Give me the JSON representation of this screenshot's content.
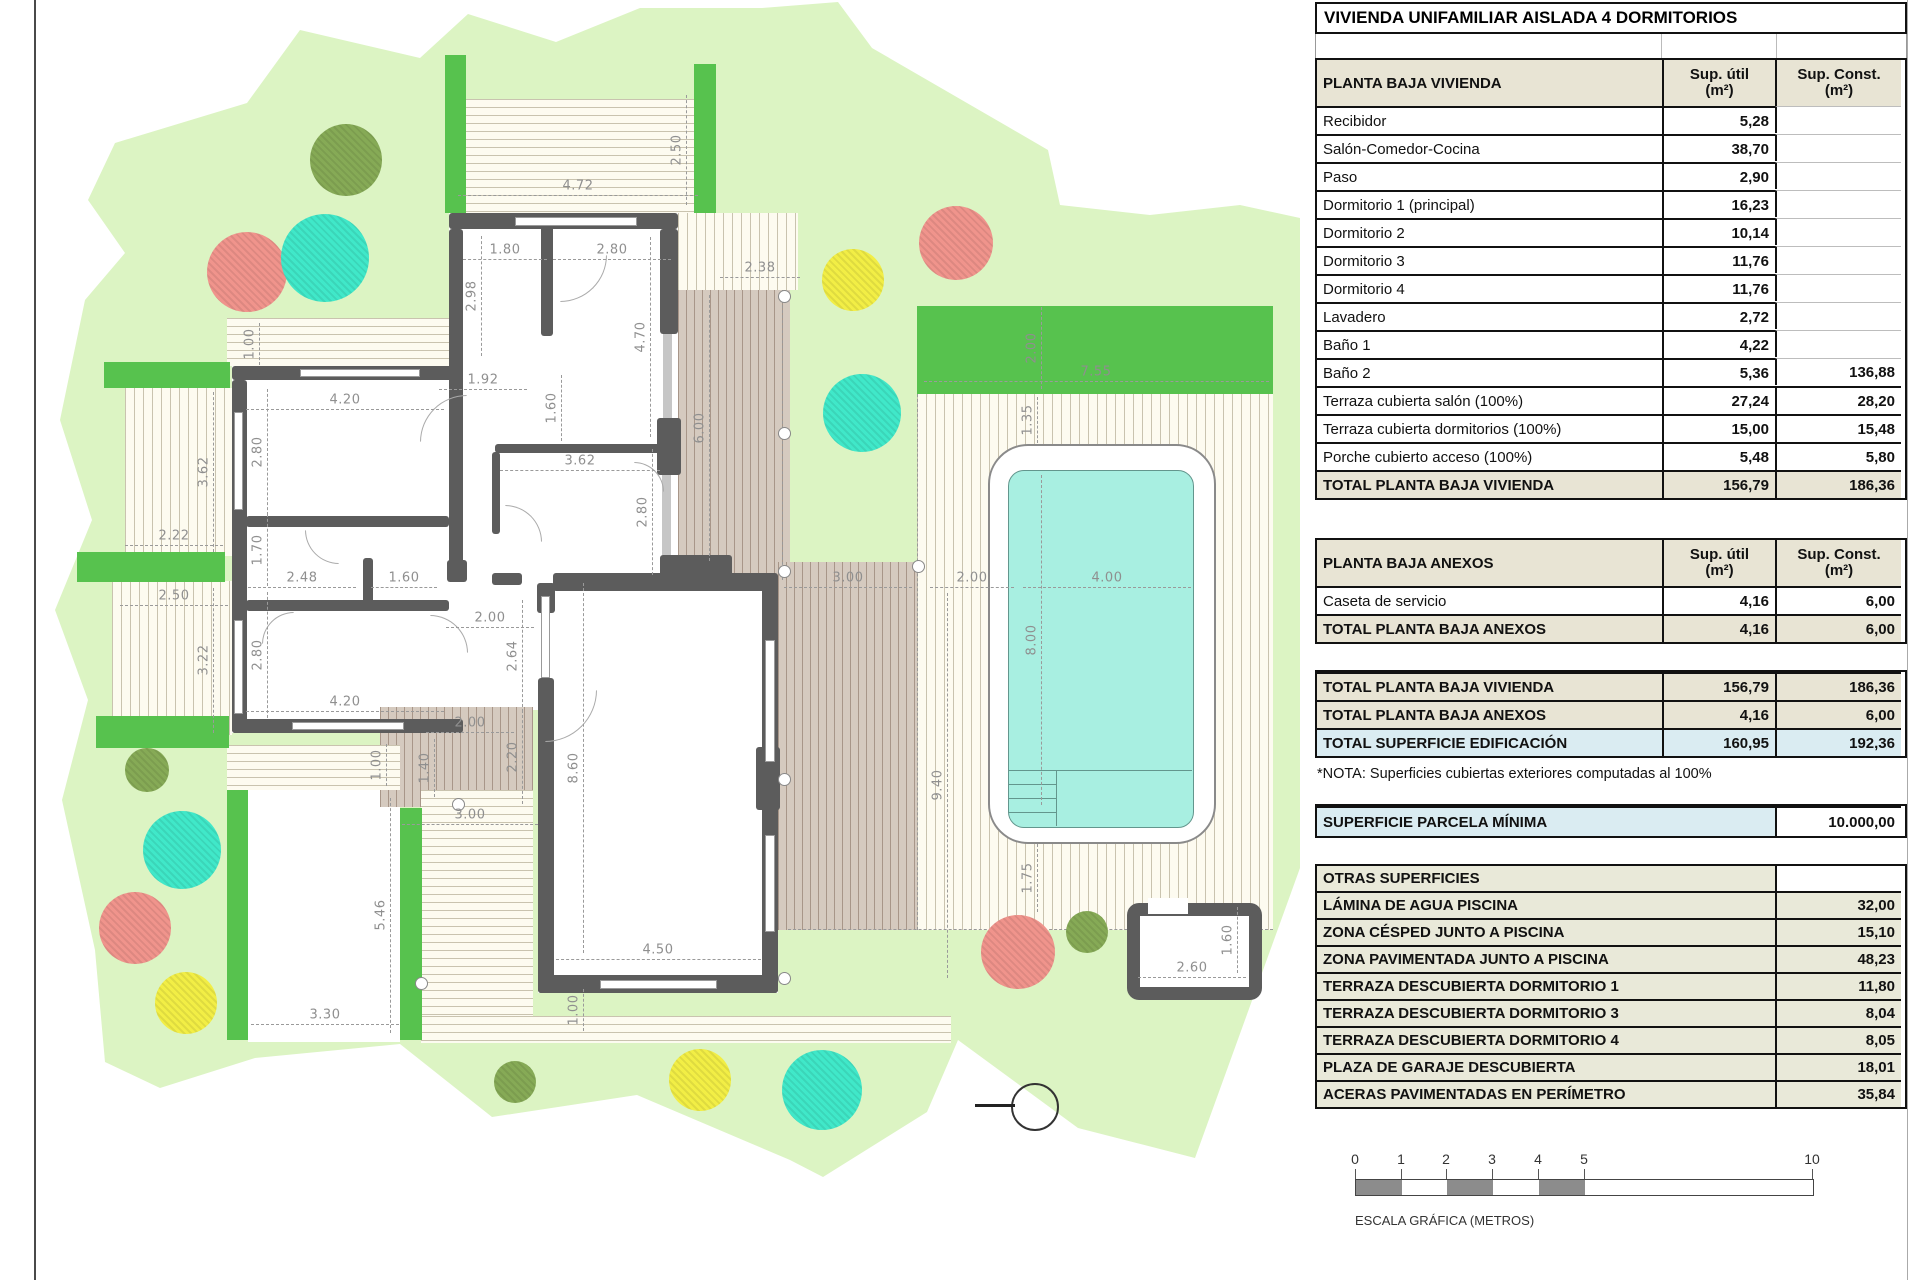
{
  "title": "VIVIENDA UNIFAMILIAR AISLADA 4 DORMITORIOS",
  "tables": {
    "col_util": "Sup. útil",
    "col_const": "Sup. Const.",
    "col_unit": "(m²)",
    "vivienda": {
      "title": "PLANTA BAJA VIVIENDA",
      "rows": [
        {
          "label": "Recibidor",
          "util": "5,28",
          "const": ""
        },
        {
          "label": "Salón-Comedor-Cocina",
          "util": "38,70",
          "const": ""
        },
        {
          "label": "Paso",
          "util": "2,90",
          "const": ""
        },
        {
          "label": "Dormitorio 1 (principal)",
          "util": "16,23",
          "const": ""
        },
        {
          "label": "Dormitorio 2",
          "util": "10,14",
          "const": ""
        },
        {
          "label": "Dormitorio 3",
          "util": "11,76",
          "const": ""
        },
        {
          "label": "Dormitorio 4",
          "util": "11,76",
          "const": ""
        },
        {
          "label": "Lavadero",
          "util": "2,72",
          "const": ""
        },
        {
          "label": "Baño 1",
          "util": "4,22",
          "const": ""
        },
        {
          "label": "Baño 2",
          "util": "5,36",
          "const": "136,88"
        },
        {
          "label": "Terraza cubierta salón (100%)",
          "util": "27,24",
          "const": "28,20"
        },
        {
          "label": "Terraza cubierta dormitorios (100%)",
          "util": "15,00",
          "const": "15,48"
        },
        {
          "label": "Porche cubierto acceso (100%)",
          "util": "5,48",
          "const": "5,80"
        }
      ],
      "total": {
        "label": "TOTAL PLANTA BAJA VIVIENDA",
        "util": "156,79",
        "const": "186,36"
      }
    },
    "anexos": {
      "title": "PLANTA BAJA ANEXOS",
      "rows": [
        {
          "label": "Caseta de servicio",
          "util": "4,16",
          "const": "6,00"
        }
      ],
      "total": {
        "label": "TOTAL PLANTA BAJA ANEXOS",
        "util": "4,16",
        "const": "6,00"
      }
    },
    "resumen": {
      "rows": [
        {
          "label": "TOTAL PLANTA BAJA VIVIENDA",
          "util": "156,79",
          "const": "186,36",
          "style": "beige"
        },
        {
          "label": "TOTAL PLANTA BAJA ANEXOS",
          "util": "4,16",
          "const": "6,00",
          "style": "beige"
        },
        {
          "label": "TOTAL SUPERFICIE EDIFICACIÓN",
          "util": "160,95",
          "const": "192,36",
          "style": "blue"
        }
      ]
    },
    "nota": "*NOTA: Superficies cubiertas exteriores computadas al 100%",
    "parcela": {
      "label": "SUPERFICIE PARCELA MÍNIMA",
      "value": "10.000,00"
    },
    "otras": {
      "title": "OTRAS SUPERFICIES",
      "rows": [
        {
          "label": "LÁMINA DE AGUA PISCINA",
          "value": "32,00"
        },
        {
          "label": "ZONA CÉSPED JUNTO A PISCINA",
          "value": "15,10"
        },
        {
          "label": "ZONA PAVIMENTADA JUNTO A PISCINA",
          "value": "48,23"
        },
        {
          "label": "TERRAZA DESCUBIERTA DORMITORIO 1",
          "value": "11,80"
        },
        {
          "label": "TERRAZA DESCUBIERTA DORMITORIO 3",
          "value": "8,04"
        },
        {
          "label": "TERRAZA DESCUBIERTA DORMITORIO 4",
          "value": "8,05"
        },
        {
          "label": "PLAZA DE GARAJE DESCUBIERTA",
          "value": "18,01"
        },
        {
          "label": "ACERAS PAVIMENTADAS EN PERÍMETRO",
          "value": "35,84"
        }
      ]
    }
  },
  "scalebar": {
    "caption": "ESCALA GRÁFICA (METROS)",
    "ticks": [
      {
        "t": "0",
        "p": 0
      },
      {
        "t": "1",
        "p": 46
      },
      {
        "t": "2",
        "p": 91
      },
      {
        "t": "3",
        "p": 137
      },
      {
        "t": "4",
        "p": 183
      },
      {
        "t": "5",
        "p": 229
      },
      {
        "t": "10",
        "p": 457
      }
    ],
    "segments": [
      {
        "w": 46,
        "c": "#8c8c8c"
      },
      {
        "w": 45,
        "c": "#ffffff"
      },
      {
        "w": 46,
        "c": "#8c8c8c"
      },
      {
        "w": 46,
        "c": "#ffffff"
      },
      {
        "w": 46,
        "c": "#8c8c8c"
      },
      {
        "w": 228,
        "c": "#ffffff"
      }
    ]
  },
  "plan": {
    "colors": {
      "garden": "#dcf4c3",
      "hedge": "#57c24e",
      "wall": "#5c5c5c",
      "pool_water": "#a8efe1",
      "tree_red": "#f0948c",
      "tree_teal": "#40e8c9",
      "tree_yellow": "#f2ee45",
      "tree_olive": "#86aa56"
    },
    "dims": [
      {
        "t": "2.50",
        "x": 677,
        "y": 150,
        "r": 1,
        "len": 110
      },
      {
        "t": "4.72",
        "x": 578,
        "y": 186,
        "r": 0,
        "len": 240
      },
      {
        "t": "1.80",
        "x": 505,
        "y": 250,
        "r": 0,
        "len": 84
      },
      {
        "t": "2.80",
        "x": 612,
        "y": 250,
        "r": 0,
        "len": 118
      },
      {
        "t": "2.38",
        "x": 760,
        "y": 268,
        "r": 0,
        "len": 80
      },
      {
        "t": "2.98",
        "x": 472,
        "y": 296,
        "r": 1,
        "len": 120
      },
      {
        "t": "1.00",
        "x": 250,
        "y": 344,
        "r": 1,
        "len": 42
      },
      {
        "t": "4.70",
        "x": 641,
        "y": 337,
        "r": 1,
        "len": 200
      },
      {
        "t": "1.92",
        "x": 483,
        "y": 380,
        "r": 0,
        "len": 88
      },
      {
        "t": "4.20",
        "x": 345,
        "y": 400,
        "r": 0,
        "len": 198
      },
      {
        "t": "2.80",
        "x": 258,
        "y": 452,
        "r": 1,
        "len": 126
      },
      {
        "t": "3.62",
        "x": 204,
        "y": 472,
        "r": 1,
        "len": 160
      },
      {
        "t": "1.60",
        "x": 552,
        "y": 408,
        "r": 1,
        "len": 66
      },
      {
        "t": "3.62",
        "x": 580,
        "y": 461,
        "r": 0,
        "len": 160
      },
      {
        "t": "6.00",
        "x": 700,
        "y": 428,
        "r": 1,
        "len": 266
      },
      {
        "t": "2.22",
        "x": 174,
        "y": 536,
        "r": 0,
        "len": 98
      },
      {
        "t": "1.70",
        "x": 258,
        "y": 550,
        "r": 1,
        "len": 72
      },
      {
        "t": "2.48",
        "x": 302,
        "y": 578,
        "r": 0,
        "len": 108
      },
      {
        "t": "1.60",
        "x": 404,
        "y": 578,
        "r": 0,
        "len": 66
      },
      {
        "t": "2.80",
        "x": 643,
        "y": 512,
        "r": 1,
        "len": 126
      },
      {
        "t": "2.50",
        "x": 174,
        "y": 596,
        "r": 0,
        "len": 108
      },
      {
        "t": "3.22",
        "x": 204,
        "y": 660,
        "r": 1,
        "len": 145
      },
      {
        "t": "2.80",
        "x": 258,
        "y": 655,
        "r": 1,
        "len": 126
      },
      {
        "t": "4.20",
        "x": 345,
        "y": 702,
        "r": 0,
        "len": 198
      },
      {
        "t": "2.00",
        "x": 490,
        "y": 618,
        "r": 0,
        "len": 88
      },
      {
        "t": "2.64",
        "x": 513,
        "y": 656,
        "r": 1,
        "len": 112
      },
      {
        "t": "2.00",
        "x": 470,
        "y": 723,
        "r": 0,
        "len": 88
      },
      {
        "t": "2.20",
        "x": 513,
        "y": 757,
        "r": 1,
        "len": 94
      },
      {
        "t": "1.40",
        "x": 425,
        "y": 768,
        "r": 1,
        "len": 58
      },
      {
        "t": "1.00",
        "x": 377,
        "y": 765,
        "r": 1,
        "len": 42
      },
      {
        "t": "3.00",
        "x": 470,
        "y": 815,
        "r": 0,
        "len": 136
      },
      {
        "t": "8.60",
        "x": 574,
        "y": 768,
        "r": 1,
        "len": 370
      },
      {
        "t": "5.46",
        "x": 381,
        "y": 915,
        "r": 1,
        "len": 235
      },
      {
        "t": "3.30",
        "x": 325,
        "y": 1015,
        "r": 0,
        "len": 148
      },
      {
        "t": "4.50",
        "x": 658,
        "y": 950,
        "r": 0,
        "len": 205
      },
      {
        "t": "1.00",
        "x": 574,
        "y": 1010,
        "r": 1,
        "len": 42
      },
      {
        "t": "3.00",
        "x": 848,
        "y": 578,
        "r": 0,
        "len": 128
      },
      {
        "t": "2.00",
        "x": 972,
        "y": 578,
        "r": 0,
        "len": 84
      },
      {
        "t": "4.00",
        "x": 1107,
        "y": 578,
        "r": 0,
        "len": 168
      },
      {
        "t": "8.00",
        "x": 1032,
        "y": 640,
        "r": 1,
        "len": 330
      },
      {
        "t": "9.40",
        "x": 938,
        "y": 785,
        "r": 1,
        "len": 385
      },
      {
        "t": "2.00",
        "x": 1032,
        "y": 348,
        "r": 1,
        "len": 82
      },
      {
        "t": "7.55",
        "x": 1096,
        "y": 372,
        "r": 0,
        "len": 345
      },
      {
        "t": "1.35",
        "x": 1028,
        "y": 420,
        "r": 1,
        "len": 46
      },
      {
        "t": "1.75",
        "x": 1028,
        "y": 878,
        "r": 1,
        "len": 68
      },
      {
        "t": "2.60",
        "x": 1192,
        "y": 968,
        "r": 0,
        "len": 108
      },
      {
        "t": "1.60",
        "x": 1228,
        "y": 940,
        "r": 1,
        "len": 66
      }
    ],
    "trees": [
      {
        "x": 346,
        "y": 160,
        "rad": 36,
        "c": "tree_olive"
      },
      {
        "x": 247,
        "y": 272,
        "rad": 40,
        "c": "tree_red"
      },
      {
        "x": 325,
        "y": 258,
        "rad": 44,
        "c": "tree_teal"
      },
      {
        "x": 853,
        "y": 280,
        "rad": 31,
        "c": "tree_yellow"
      },
      {
        "x": 956,
        "y": 243,
        "rad": 37,
        "c": "tree_red"
      },
      {
        "x": 862,
        "y": 413,
        "rad": 39,
        "c": "tree_teal"
      },
      {
        "x": 147,
        "y": 770,
        "rad": 22,
        "c": "tree_olive"
      },
      {
        "x": 182,
        "y": 850,
        "rad": 39,
        "c": "tree_teal"
      },
      {
        "x": 135,
        "y": 928,
        "rad": 36,
        "c": "tree_red"
      },
      {
        "x": 186,
        "y": 1003,
        "rad": 31,
        "c": "tree_yellow"
      },
      {
        "x": 515,
        "y": 1082,
        "rad": 21,
        "c": "tree_olive"
      },
      {
        "x": 700,
        "y": 1080,
        "rad": 31,
        "c": "tree_yellow"
      },
      {
        "x": 822,
        "y": 1090,
        "rad": 40,
        "c": "tree_teal"
      },
      {
        "x": 1018,
        "y": 952,
        "rad": 37,
        "c": "tree_red"
      },
      {
        "x": 1087,
        "y": 932,
        "rad": 21,
        "c": "tree_olive"
      }
    ]
  }
}
